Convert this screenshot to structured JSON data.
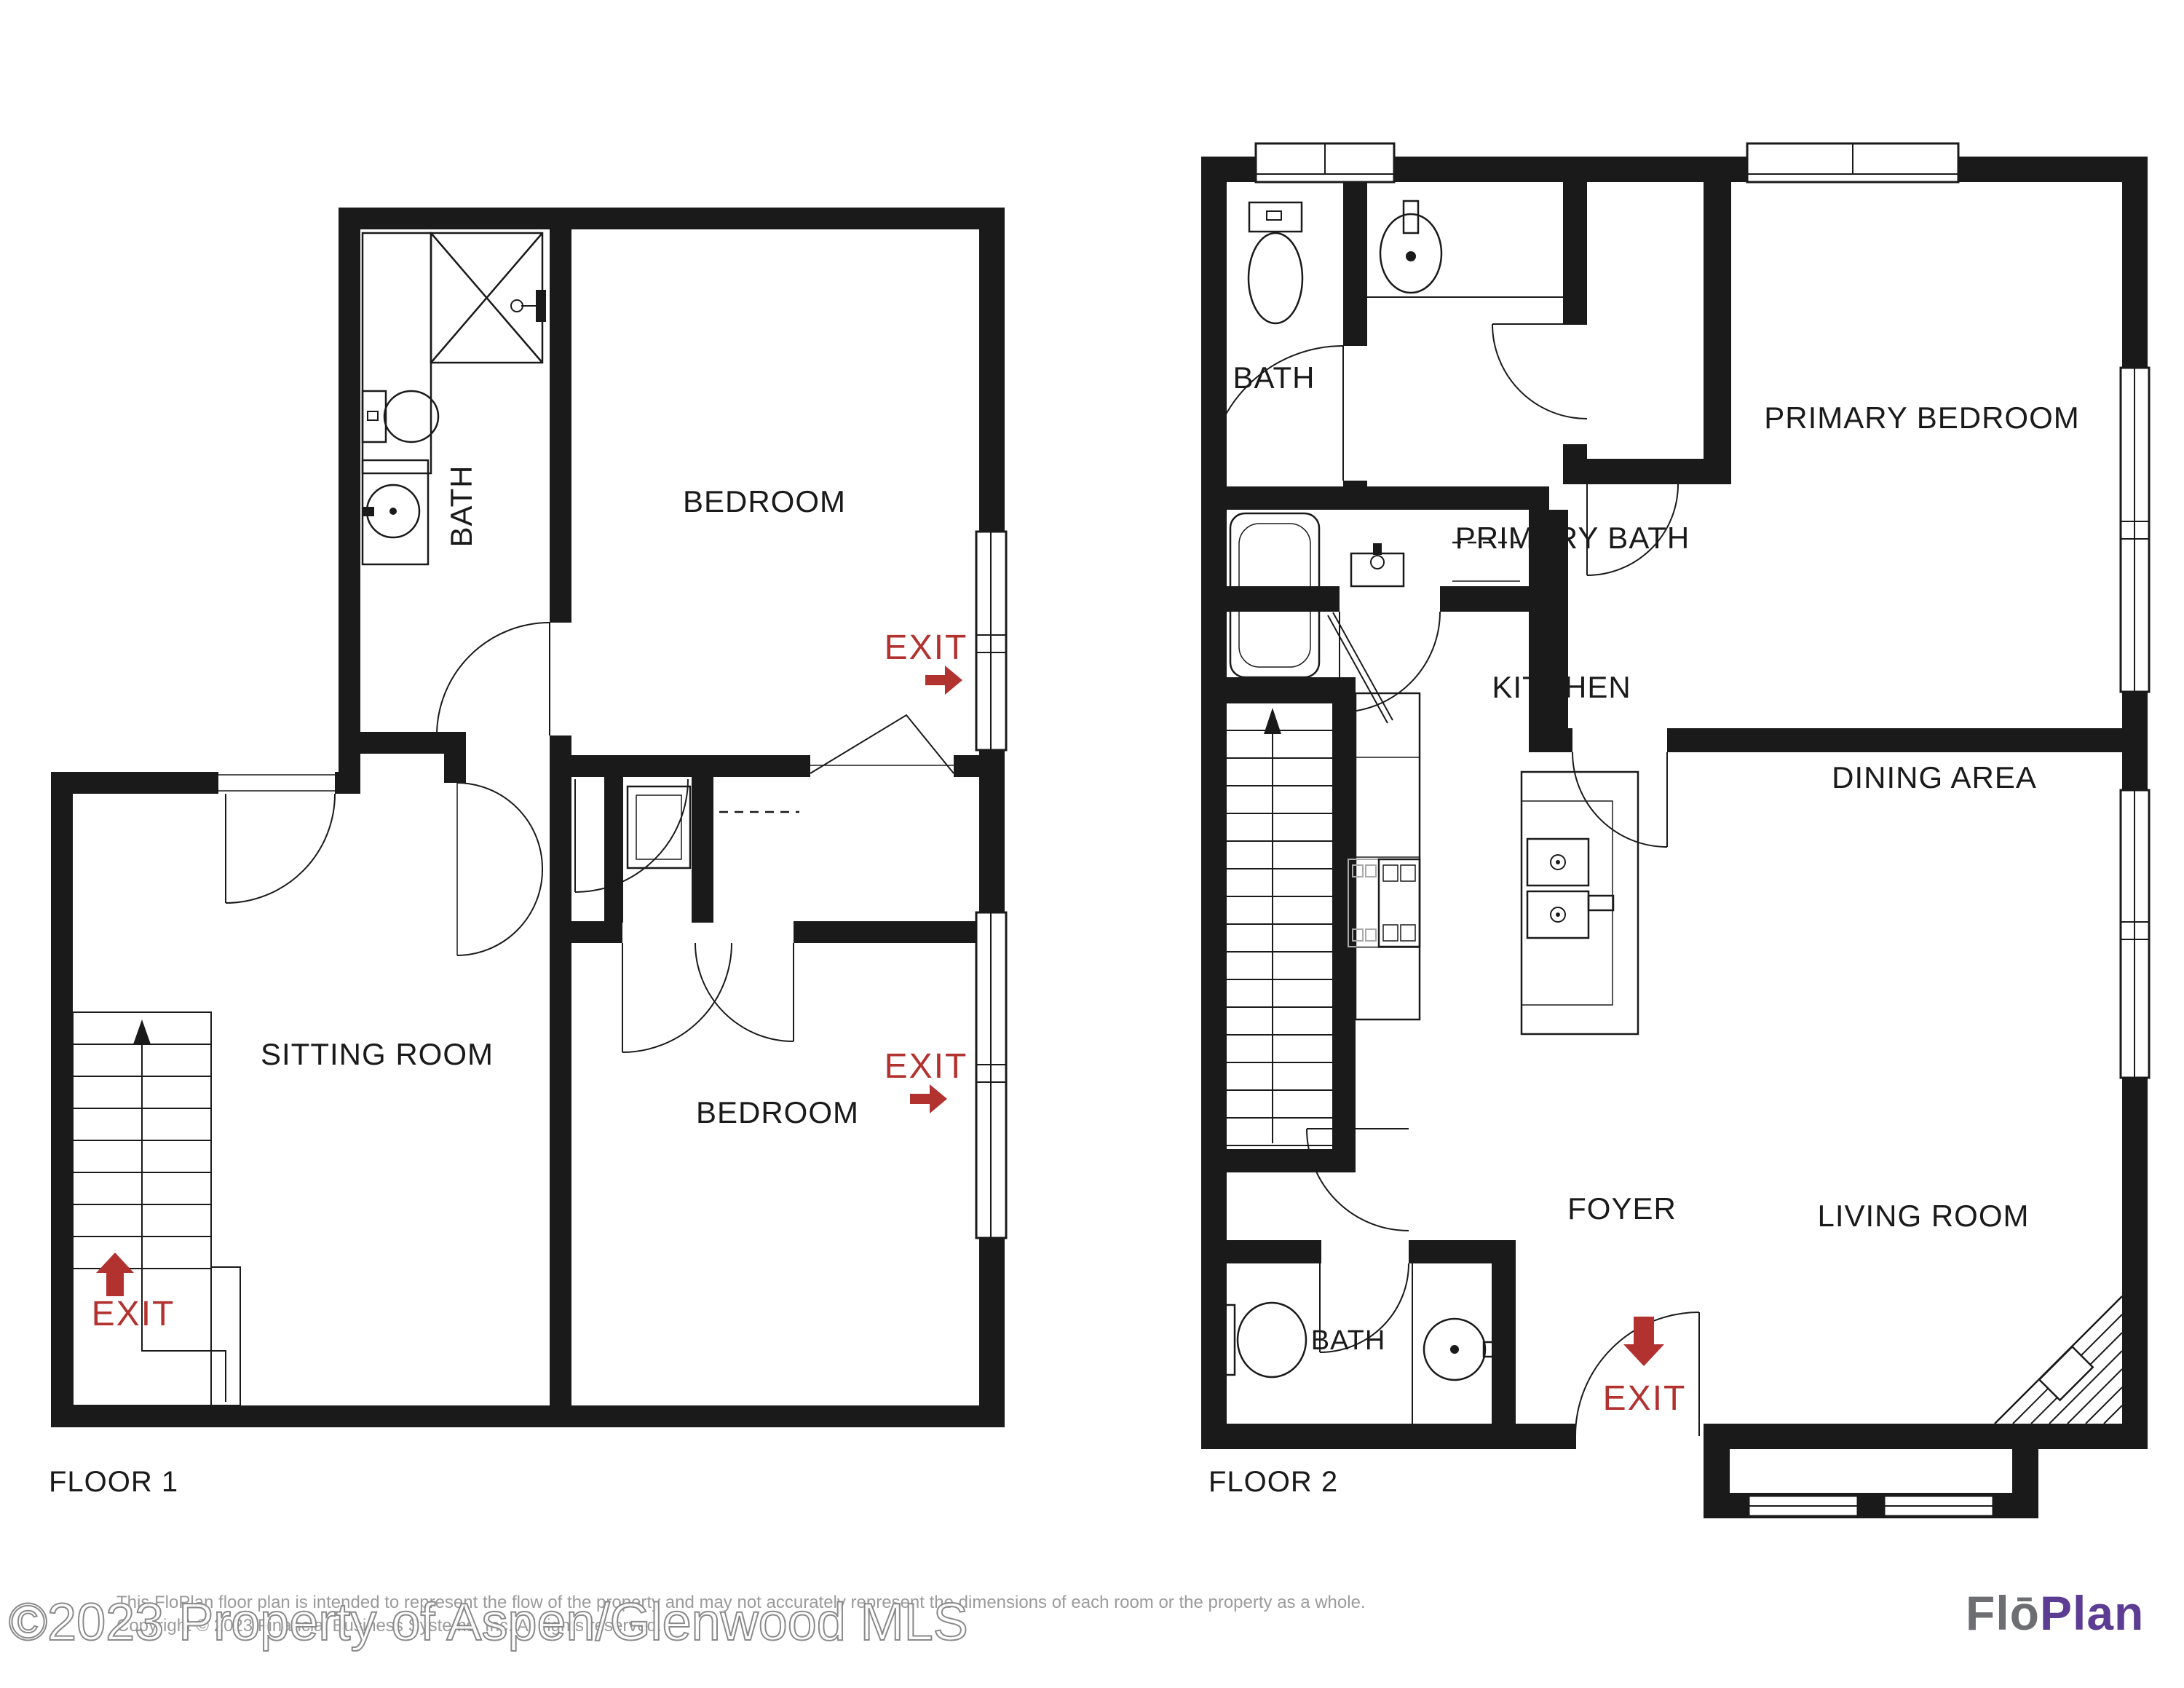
{
  "floor1": {
    "title": "FLOOR 1",
    "bath": "BATH",
    "bedroom_upper": "BEDROOM",
    "sitting_room": "SITTING ROOM",
    "bedroom_lower": "BEDROOM",
    "exit_upper": "EXIT",
    "exit_lower": "EXIT",
    "exit_stairs": "EXIT"
  },
  "floor2": {
    "title": "FLOOR 2",
    "bath_upper": "BATH",
    "primary_bath": "PRIMARY BATH",
    "primary_bedroom": "PRIMARY BEDROOM",
    "kitchen": "KITCHEN",
    "dining_area": "DINING AREA",
    "living_room": "LIVING ROOM",
    "foyer": "FOYER",
    "bath_lower": "BATH",
    "exit": "EXIT"
  },
  "footer": {
    "watermark": "©2023 Property of Aspen/Glenwood MLS",
    "disclaimer_line1": "This FloPlan floor plan is intended to represent the flow of the property and may not accurately represent the dimensions of each room or the property as a whole.",
    "disclaimer_line2": "Copyright © 2023 Financial Business Systems, Inc. All rights reserved.",
    "logo_flo": "Flō",
    "logo_plan": "Plan"
  },
  "colors": {
    "walls": "#1a1a1a",
    "exit_red": "#b23230",
    "logo_gray": "#6d6e71",
    "logo_purple": "#5c3d93",
    "watermark_outline": "#8a8a8a",
    "disclaimer_gray": "#9b9b9b"
  }
}
